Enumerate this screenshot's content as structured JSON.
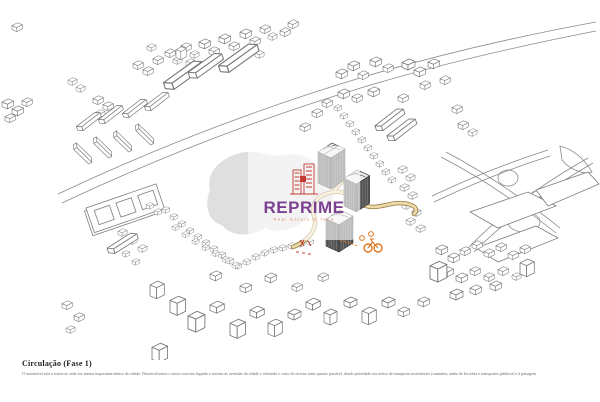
{
  "document": {
    "background": "#ffffff",
    "type": "architectural-circulation-diagram"
  },
  "watermark": {
    "brand": "REPRIME",
    "tagline": "Real Estate & Tech",
    "brand_color": "#7c4191",
    "tagline_color": "#e07a5f",
    "logo_color": "#c43b33",
    "logo": "buildings-sketch-icon"
  },
  "caption": {
    "title": "Circulação (Fase 1)",
    "body": "O automóvel está a tornar-se cada vez menos importante dentro da cidade. Desenvolvemos o nosso conceito ligando o terreno às avenidas da cidade e retirando o carro do terreno tanto quanto possível, dando prioridade aos meios de transporte sustentáveis (caminhar, andar de bicicleta e transportes públicos) e à paisagem."
  },
  "drawing": {
    "style": "axonometric white line drawing of city blocks",
    "features": [
      "existing-city-blocks-outline",
      "main-road-curve",
      "proposed-towers-hatched",
      "pedestrian-path-tan",
      "bicycle-icon-orange",
      "park-paths",
      "pond-gray",
      "slab-block-with-courtyards",
      "red-accent-route"
    ],
    "colors": {
      "line": "#787878",
      "tower_top": "#e9e9e9",
      "tower_side": "#4c4c4c",
      "path_fill": "#ead9a9",
      "path_outline": "#96783f",
      "bike_orange": "#e2751d",
      "accent_red": "#c0392b",
      "pond": "#dcdcdc"
    }
  }
}
